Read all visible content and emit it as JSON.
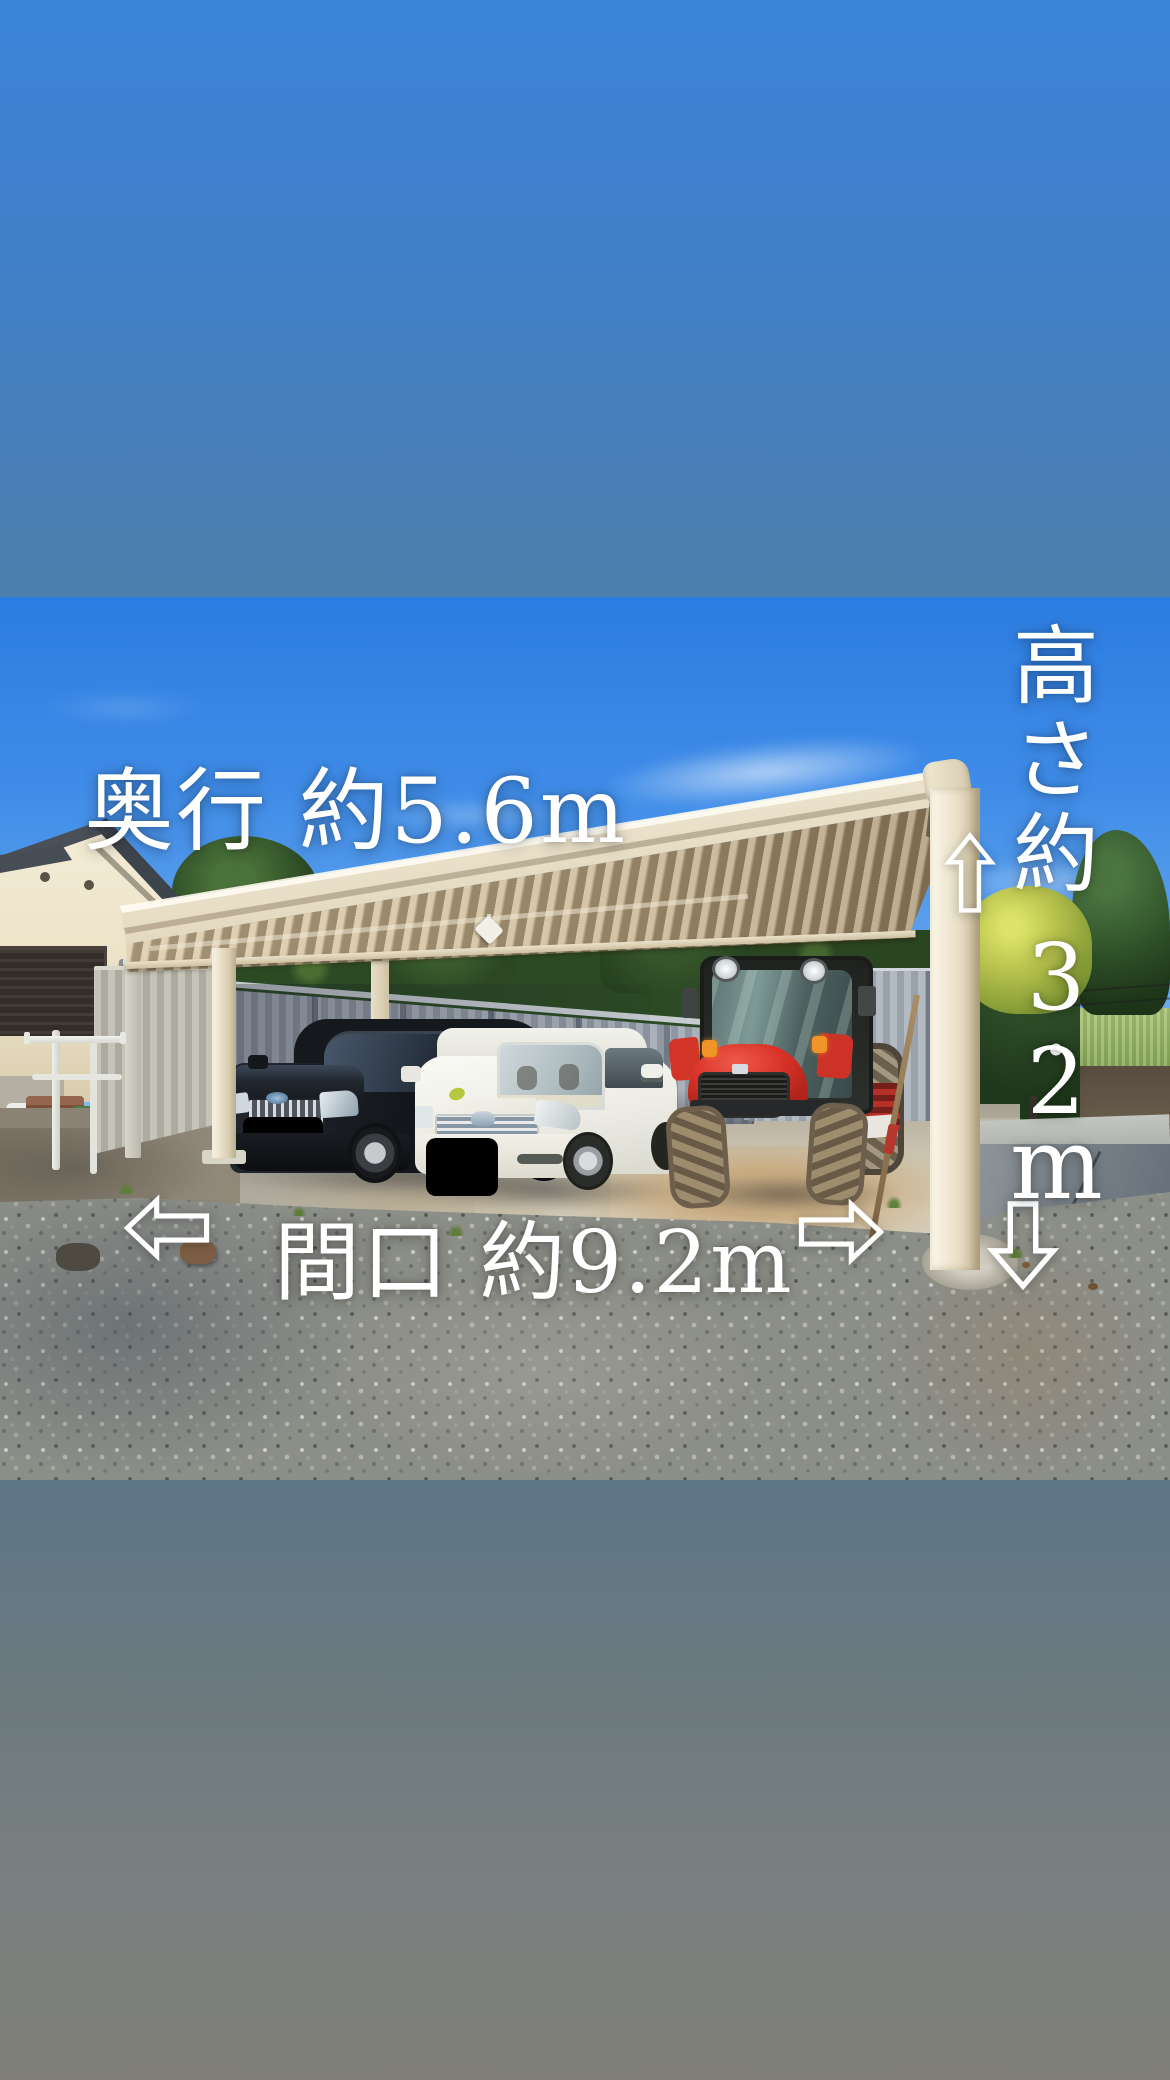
{
  "app": {
    "type": "photo-story",
    "content": "carport exterior photo with dimension annotations"
  },
  "palette": {
    "background_top": "#3c84da",
    "background_upper_mid": "#4d7fad",
    "background_lower_mid": "#5d7688",
    "background_bottom": "#7f7f77",
    "sky_top": "#2c7de2",
    "sky_bottom": "#8abdf1",
    "carport_beige": "#e9e0ca",
    "fence_gray": "#9aa3ad",
    "tractor_red": "#d93328",
    "annotation_text": "#ffffff"
  },
  "photo": {
    "alt": "Carport with a black minivan, a white minivan and a red tractor parked inside, gravel yard in front, house on the left",
    "objects": [
      "house",
      "carport",
      "black-minivan",
      "white-minivan",
      "red-tractor",
      "metal-fence",
      "hedge",
      "gravel-ground",
      "laundry-pole-stand"
    ]
  },
  "annotations": {
    "color": "#ffffff",
    "depth": {
      "text": "奥行 約5.6m"
    },
    "width": {
      "text": "間口 約9.2m"
    },
    "height": {
      "text": "高さ約3.2m",
      "chars": [
        "高",
        "さ",
        "約",
        "3",
        ".",
        "2",
        "m"
      ]
    },
    "arrows": {
      "left": "⇦",
      "right": "⇨",
      "up": "⇧",
      "down": "⇩"
    }
  }
}
